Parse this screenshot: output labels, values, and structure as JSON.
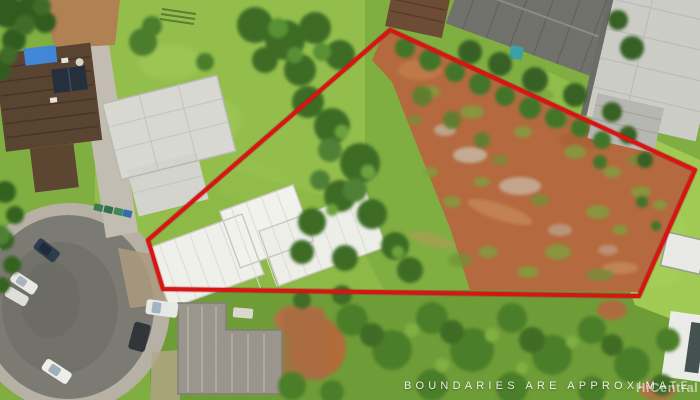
{
  "image": {
    "kind": "aerial-property-photo",
    "disclaimer": "BOUNDARIES ARE APPROXIMATE",
    "watermark": "HiCentral ML"
  },
  "boundary": {
    "color": "#d81414",
    "underlay_color": "#8a0a0a",
    "stroke_width": 4,
    "points": "390,30 695,170 639,296 163,289 148,240"
  },
  "palette": {
    "grass_mid": "#7fae3f",
    "grass_bright": "#9dc84e",
    "dirt_lot": "#b4683c",
    "road_asphalt": "#7a7a72",
    "sidewalk": "#b6b1a4",
    "roof_white": "#f1f1ec",
    "roof_gray": "#9a958c",
    "roof_brown": "#57412f",
    "roof_concrete": "#cdcdc7",
    "roof_dark_gray": "#70706a",
    "tarp_blue": "#3f86d8",
    "tree_dark": "#2f5a1e"
  }
}
